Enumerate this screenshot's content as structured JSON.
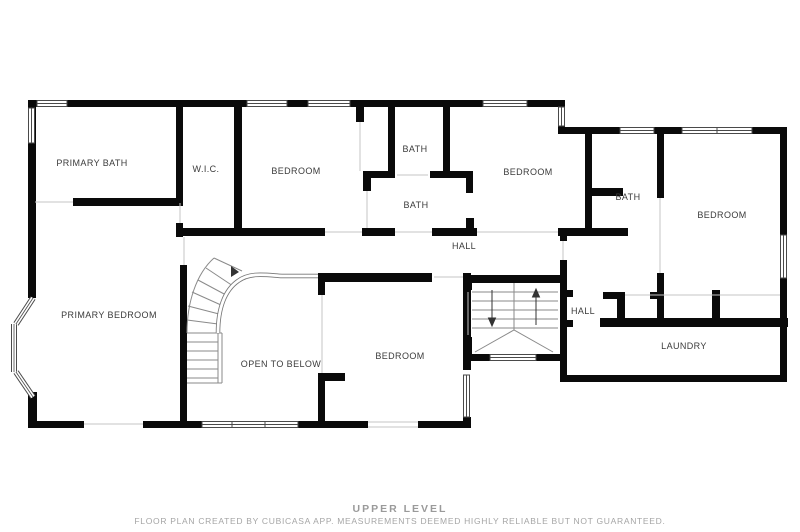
{
  "plan": {
    "level_title": "UPPER LEVEL",
    "disclaimer": "FLOOR PLAN CREATED BY CUBICASA APP. MEASUREMENTS DEEMED HIGHLY RELIABLE BUT NOT GUARANTEED.",
    "wall_color": "#0a0a0a",
    "label_color": "#3b3b3b",
    "footer_color": "#9a9a9a",
    "thin_line_color": "#c4c4c4",
    "stair_line_color": "#8a8a8a",
    "rooms": [
      {
        "id": "primary-bath",
        "label": "PRIMARY BATH",
        "x": 92,
        "y": 163
      },
      {
        "id": "wic",
        "label": "W.I.C.",
        "x": 206,
        "y": 169
      },
      {
        "id": "bedroom-top-left",
        "label": "BEDROOM",
        "x": 296,
        "y": 171
      },
      {
        "id": "bath-top",
        "label": "BATH",
        "x": 415,
        "y": 149
      },
      {
        "id": "bath-middle",
        "label": "BATH",
        "x": 416,
        "y": 205
      },
      {
        "id": "bedroom-top-center",
        "label": "BEDROOM",
        "x": 528,
        "y": 172
      },
      {
        "id": "bath-right",
        "label": "BATH",
        "x": 628,
        "y": 197
      },
      {
        "id": "bedroom-right",
        "label": "BEDROOM",
        "x": 722,
        "y": 215
      },
      {
        "id": "hall-upper",
        "label": "HALL",
        "x": 464,
        "y": 246
      },
      {
        "id": "primary-bedroom",
        "label": "PRIMARY BEDROOM",
        "x": 109,
        "y": 315
      },
      {
        "id": "open-to-below",
        "label": "OPEN TO BELOW",
        "x": 281,
        "y": 364
      },
      {
        "id": "bedroom-bottom",
        "label": "BEDROOM",
        "x": 400,
        "y": 356
      },
      {
        "id": "hall-right",
        "label": "HALL",
        "x": 583,
        "y": 311
      },
      {
        "id": "laundry",
        "label": "LAUNDRY",
        "x": 684,
        "y": 346
      }
    ]
  }
}
